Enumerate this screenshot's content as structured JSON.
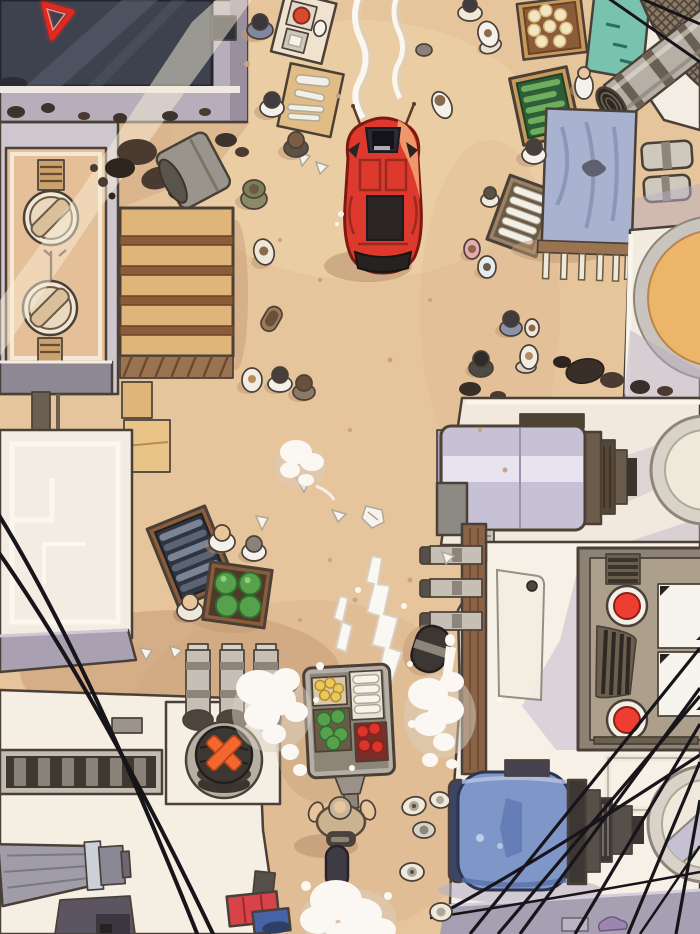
{
  "scene": {
    "description": "Overhead comic-style illustration of a dusty market street: a red sports car drives between rooftops, stalls and machinery while a vendor pushes a food cart through water splashes",
    "style": "top-down webtoon illustration panel",
    "visible_text": []
  },
  "palette": {
    "sand": "#e6c49c",
    "roof_cream": "#f2ebe0",
    "wall_lavender": "#b7aebc",
    "glass_dark": "#3d424e",
    "sign_red": "#e5271d",
    "car_red": "#dd3a2d",
    "stall_wood": "#e0b579",
    "teal_box": "#79c2ae",
    "produce_green": "#57a04c",
    "cloth_blue": "#a9b2cf",
    "metal_gray": "#b6afa6",
    "drum_lavender": "#c6c1d4",
    "vat_orange": "#ecb56a",
    "panel_taupe": "#aca08c",
    "button_red": "#ee3e31",
    "tank_blue": "#7e97c8",
    "x_orange": "#f2682e",
    "cable_black": "#17151a",
    "splash_white": "#fbf8f3",
    "street_strip_lavender": "#a79fb2",
    "skin": "#e9c59d"
  },
  "elements": [
    "red sports car",
    "exhaust smoke trails",
    "neon red triangle sign",
    "skylight window",
    "rooftop hatch circles",
    "wooden plank stall roof",
    "tipped trash barrel",
    "vegetable crate",
    "baguette crate",
    "popcorn crate",
    "fish crate",
    "melon crate",
    "blue cloth stall table",
    "rooftop water vat",
    "lavender machine drum",
    "industrial cylinder",
    "steam pipes",
    "control panel with red buttons",
    "blue storage tank",
    "hatch ring",
    "vendor food cart",
    "vendor with scooter",
    "water splashes",
    "pedestrians",
    "power cables",
    "scattered debris"
  ]
}
